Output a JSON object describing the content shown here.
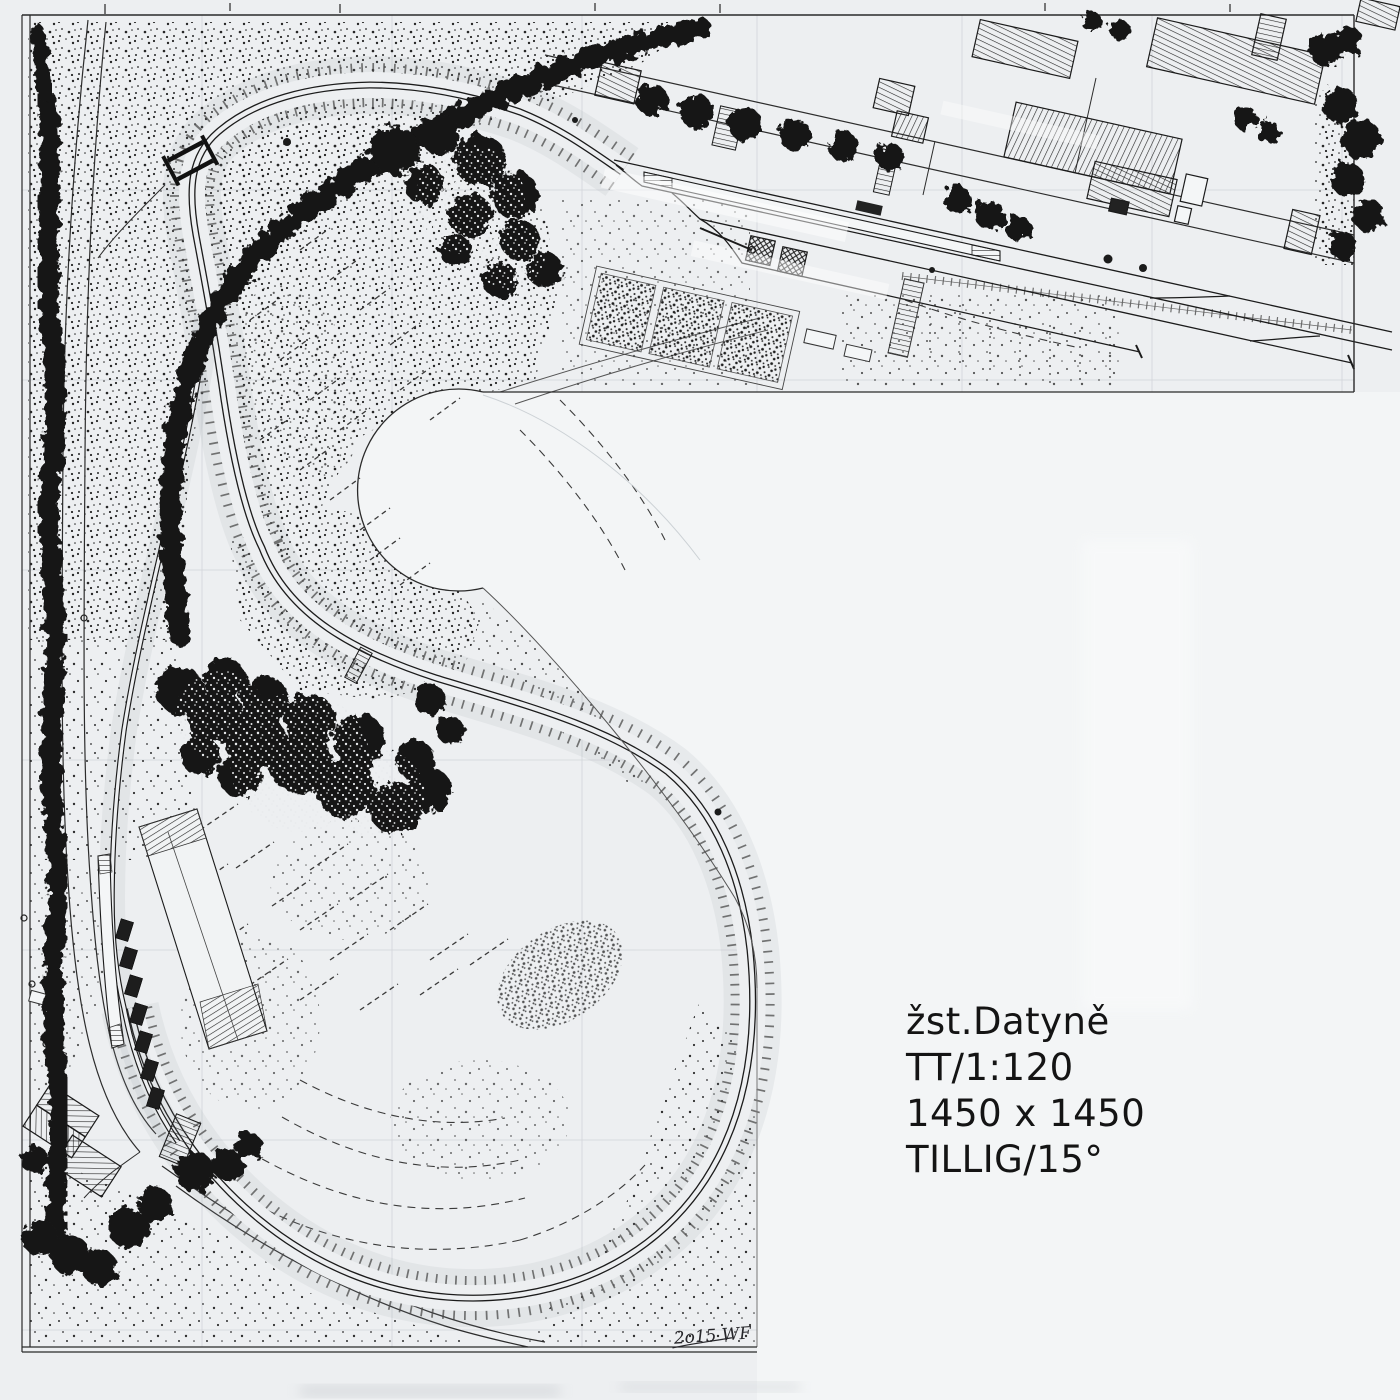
{
  "page": {
    "description": "Hand-drawn ink track plan of a TT-scale model railway layout, L-shaped benchwork, scanned paper",
    "colors": {
      "paper": "#edeff1",
      "paper_light": "#f4f6f7",
      "ink": "#1b1b1b",
      "ink_mid": "#4a4a4a",
      "pencil": "#b6bcc2"
    }
  },
  "title_block": {
    "line1": "žst.Datyně",
    "line2": "TT/1:120",
    "line3": "1450 x 1450",
    "line4": "TILLIG/15°"
  },
  "signature": "2o15 WF"
}
